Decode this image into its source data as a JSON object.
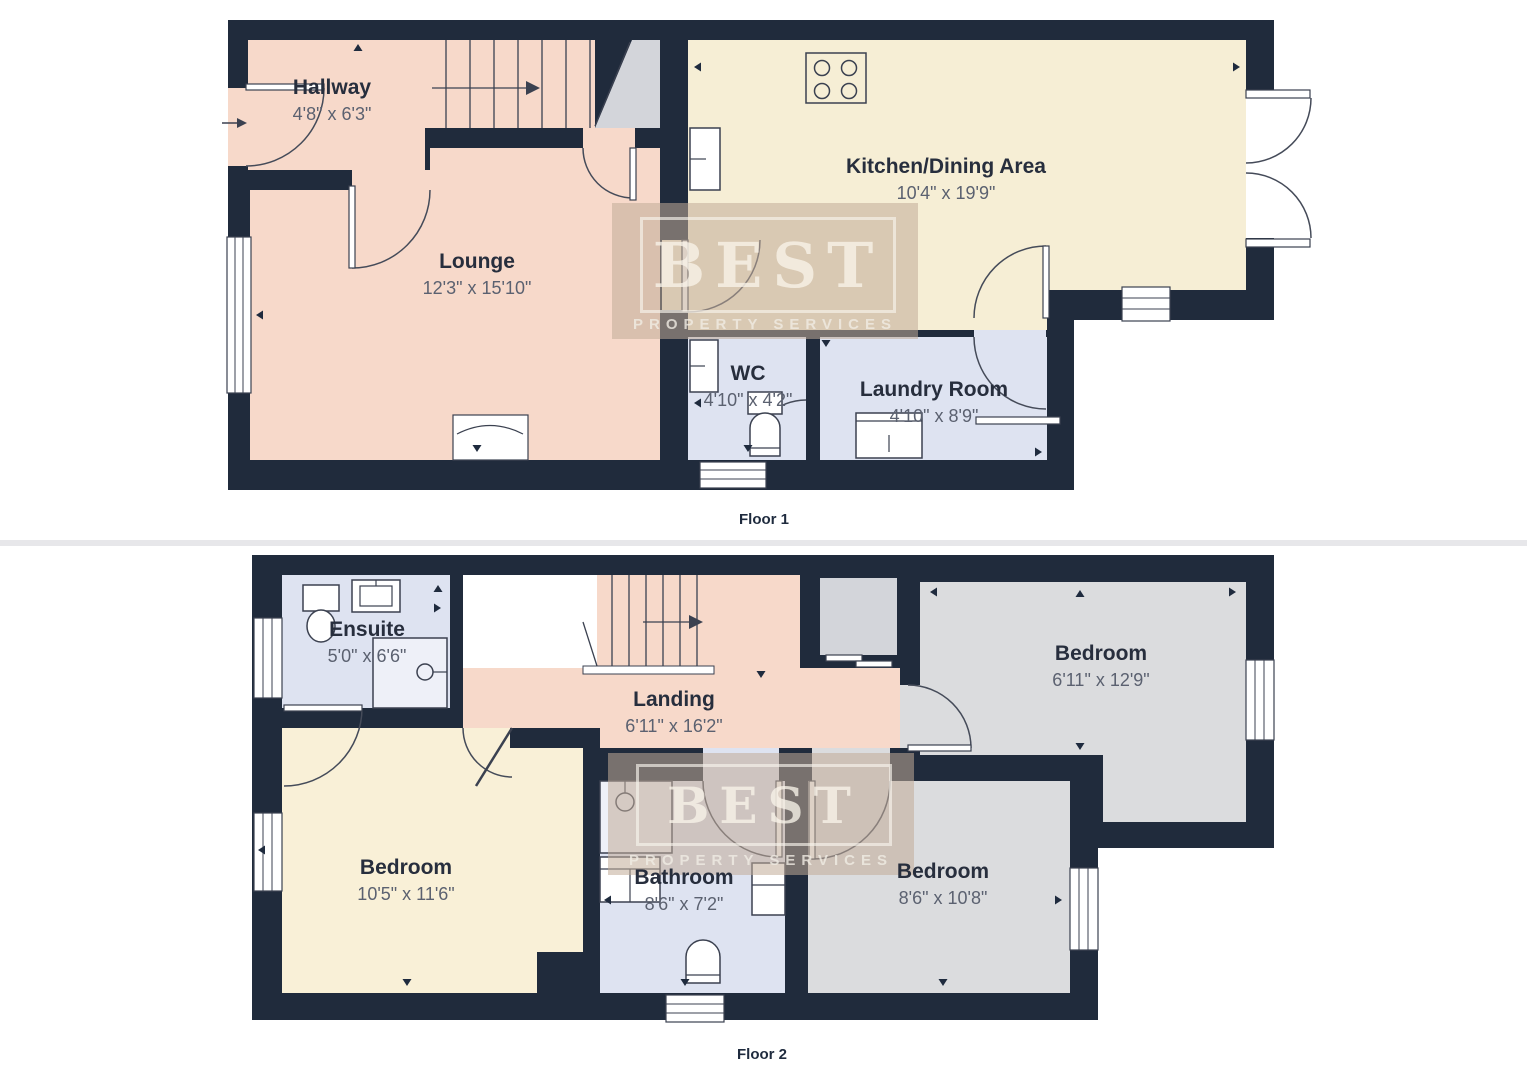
{
  "watermark": {
    "title": "BEST",
    "subtitle": "PROPERTY SERVICES"
  },
  "colors": {
    "wall": "#202b3c",
    "pink_floor": "#f7d9ca",
    "cream_floor": "#f6eed5",
    "lavender_floor": "#dee3f1",
    "gray_floor": "#dbdcde",
    "stair_gray": "#d3d5da",
    "room_name_text": "#272e3d",
    "dims_text": "#5b6170",
    "watermark_tan": "#c1ac98"
  },
  "floors": [
    {
      "label": "Floor 1",
      "rooms": [
        {
          "name": "Hallway",
          "dims": "4'8\" x 6'3\""
        },
        {
          "name": "Lounge",
          "dims": "12'3\" x 15'10\""
        },
        {
          "name": "Kitchen/Dining Area",
          "dims": "10'4\" x 19'9\""
        },
        {
          "name": "WC",
          "dims": "4'10\" x 4'2\""
        },
        {
          "name": "Laundry Room",
          "dims": "4'10\" x 8'9\""
        }
      ]
    },
    {
      "label": "Floor 2",
      "rooms": [
        {
          "name": "Ensuite",
          "dims": "5'0\" x 6'6\""
        },
        {
          "name": "Landing",
          "dims": "6'11\" x 16'2\""
        },
        {
          "name": "Bedroom",
          "dims": "6'11\" x 12'9\""
        },
        {
          "name": "Bedroom",
          "dims": "10'5\" x 11'6\""
        },
        {
          "name": "Bathroom",
          "dims": "8'6\" x 7'2\""
        },
        {
          "name": "Bedroom",
          "dims": "8'6\" x 10'8\""
        }
      ]
    }
  ]
}
